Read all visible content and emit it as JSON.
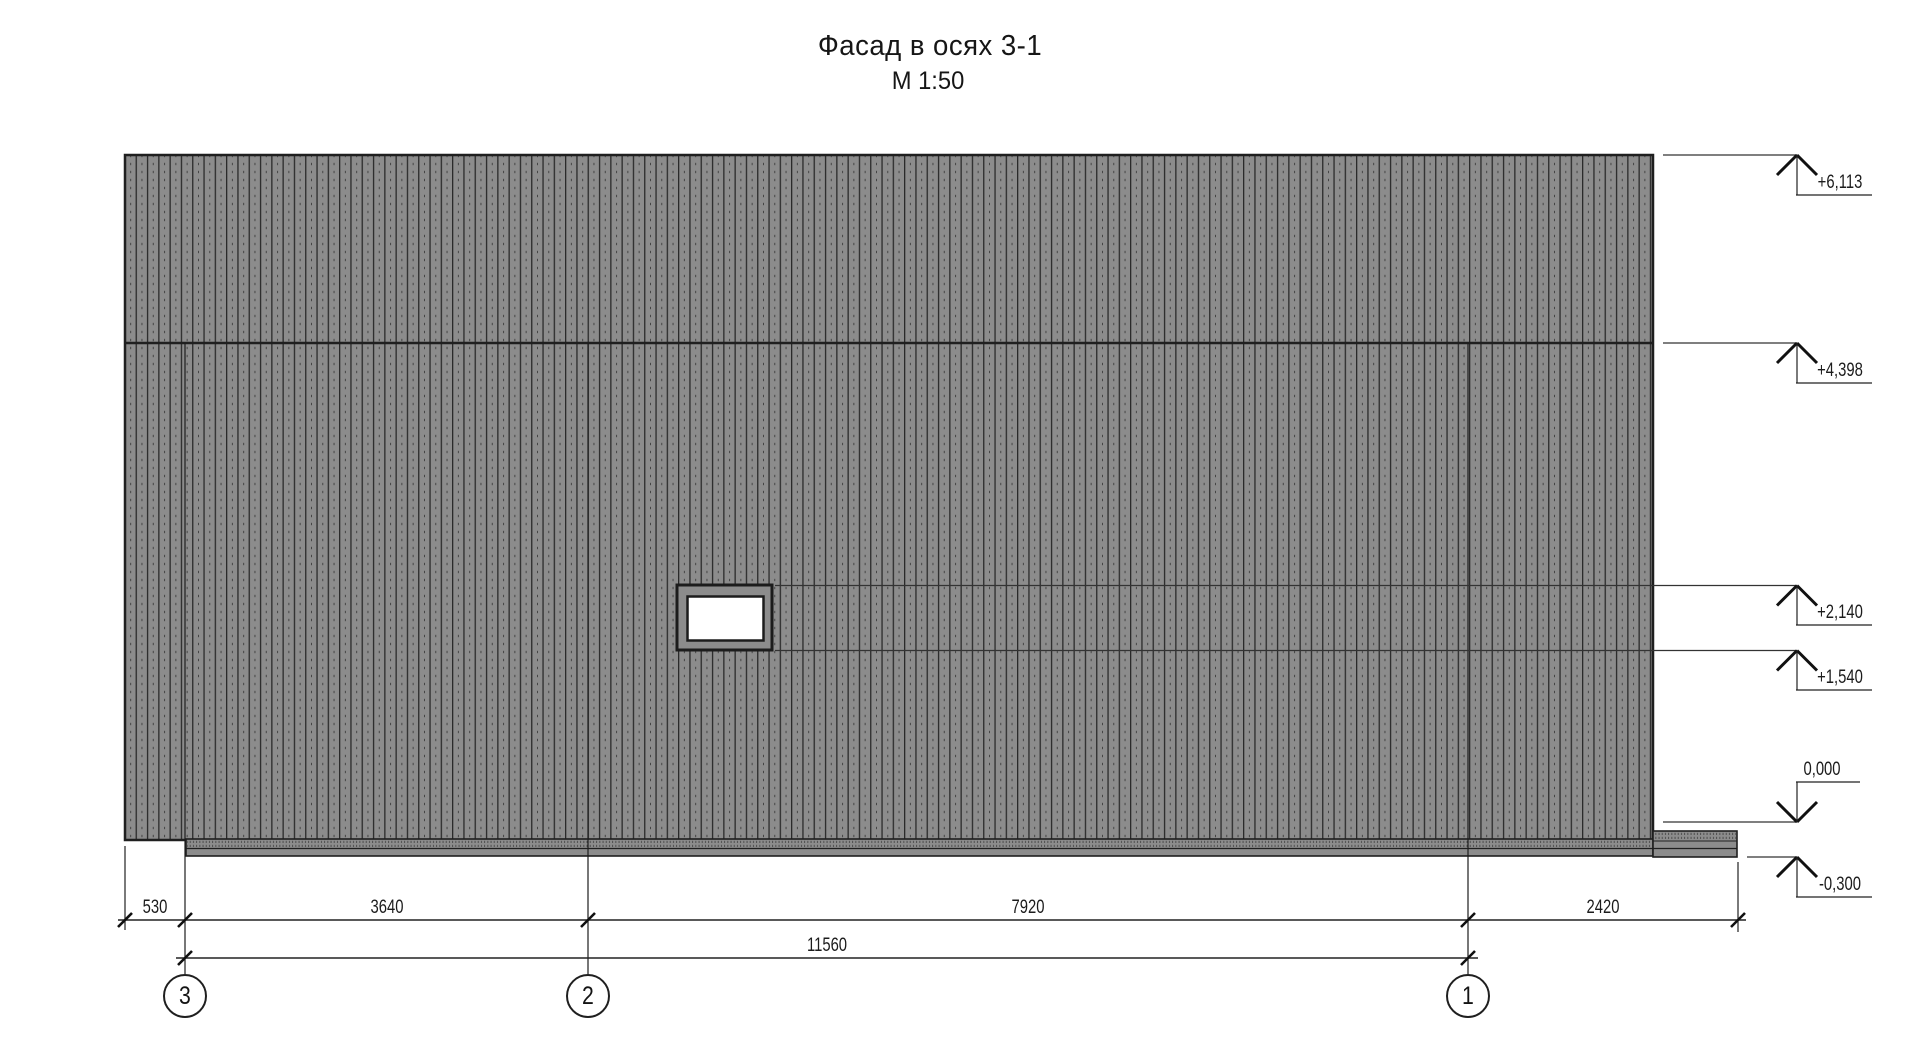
{
  "title": {
    "text": "Фасад в осях 3-1",
    "scale": "М 1:50"
  },
  "elevations": [
    {
      "label": "+6,113"
    },
    {
      "label": "+4,398"
    },
    {
      "label": "+2,140"
    },
    {
      "label": "+1,540"
    },
    {
      "label": "0,000"
    },
    {
      "label": "-0,300"
    }
  ],
  "dimensions": {
    "segments": [
      {
        "label": "530"
      },
      {
        "label": "3640"
      },
      {
        "label": "7920"
      },
      {
        "label": "2420"
      }
    ],
    "total": {
      "label": "11560"
    }
  },
  "axes": [
    {
      "label": "3"
    },
    {
      "label": "2"
    },
    {
      "label": "1"
    }
  ],
  "colors": {
    "facade_gray": "#8c8c8c",
    "line_dark": "#1f1f1f"
  }
}
